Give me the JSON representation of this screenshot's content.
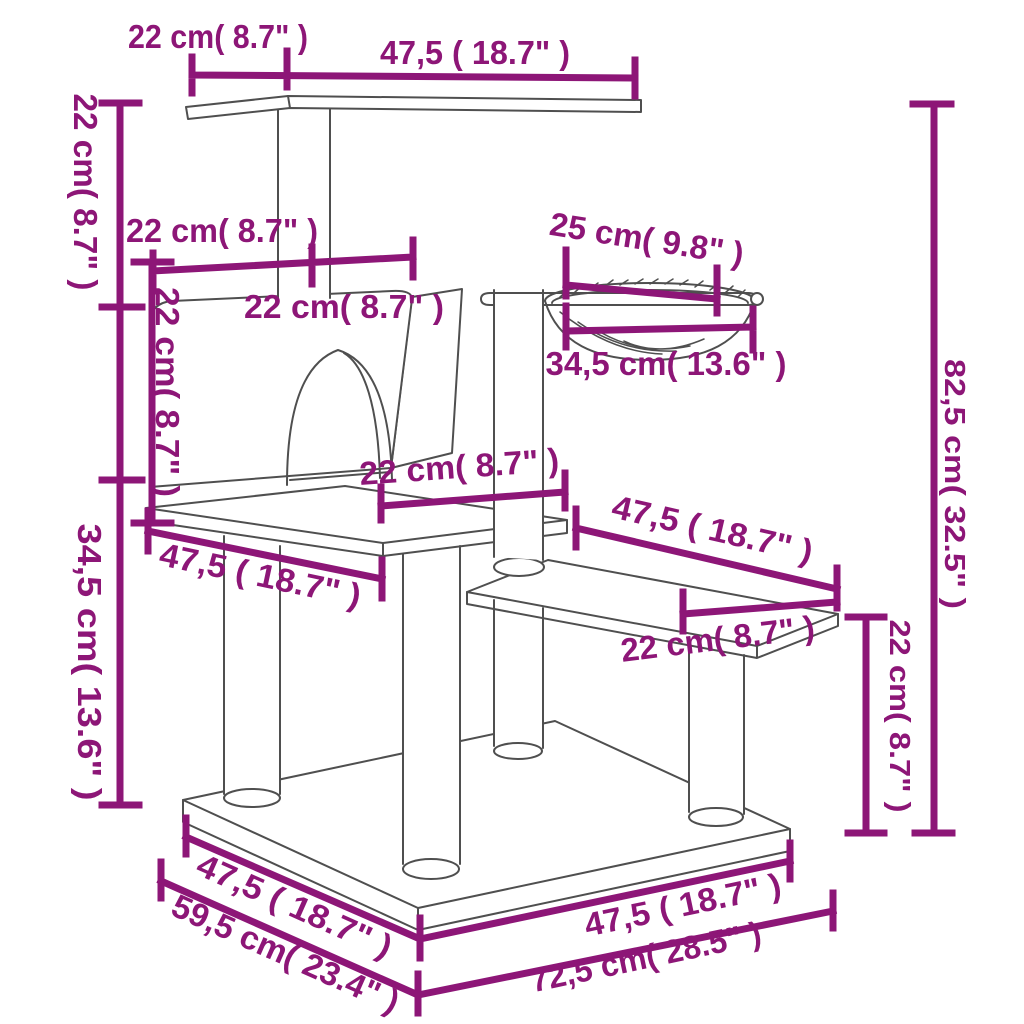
{
  "diagram": {
    "type": "product-dimension-diagram",
    "subject": "cat tree with scratching posts, house, hammock and platforms",
    "colors": {
      "dimension": "#8D1677",
      "sketch": "#4F4F4F",
      "background": "#FFFFFF"
    },
    "dims": {
      "top_post_inset": "22 cm( 8.7\" )",
      "top_platform_width": "47,5 ( 18.7\" )",
      "top_drop_height": "22 cm( 8.7\" )",
      "house_row_left_width": "22 cm( 8.7\" )",
      "house_row_right_width": "22 cm( 8.7\" )",
      "house_height": "22 cm( 8.7\" )",
      "hammock_inner_width": "25 cm( 9.8\" )",
      "hammock_outer_width": "34,5 cm( 13.6\" )",
      "house_platform_depth": "22 cm( 8.7\" )",
      "middle_platform_width": "47,5 ( 18.7\" )",
      "lower_height": "34,5 cm( 13.6\" )",
      "total_height": "82,5 cm( 32.5\" )",
      "step_width": "47,5 ( 18.7\" )",
      "step_depth": "22 cm( 8.7\" )",
      "step_height": "22 cm( 8.7\" )",
      "base_edge_left_width": "47,5 ( 18.7\" )",
      "base_depth": "59,5 cm( 23.4\" )",
      "base_edge_right_width": "47,5 ( 18.7\" )",
      "total_depth": "72,5 cm( 28.5\" )"
    }
  }
}
